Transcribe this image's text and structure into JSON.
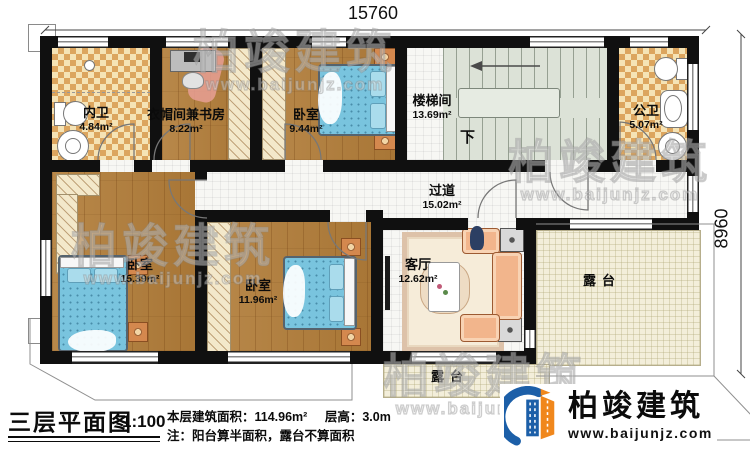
{
  "plan": {
    "dim_width": "15760",
    "dim_height": "8960",
    "rooms": {
      "inner_bath": {
        "name": "内卫",
        "area": "4.84m²"
      },
      "cloak_study": {
        "name": "衣帽间兼书房",
        "area": "8.22m²"
      },
      "bedroom_north": {
        "name": "卧室",
        "area": "9.44m²"
      },
      "stairwell": {
        "name": "楼梯间",
        "area": "13.69m²"
      },
      "public_bath": {
        "name": "公卫",
        "area": "5.07m²"
      },
      "hallway": {
        "name": "过道",
        "area": "15.02m²"
      },
      "bedroom_west": {
        "name": "卧室",
        "area": "15.39m²"
      },
      "bedroom_south": {
        "name": "卧室",
        "area": "11.96m²"
      },
      "living_room": {
        "name": "客厅",
        "area": "12.62m²"
      },
      "terrace_east": {
        "name": "露台"
      },
      "terrace_south": {
        "name": "露台"
      }
    },
    "stairs_down_label": "下"
  },
  "title_block": {
    "title": "三层平面图",
    "scale": "1:100",
    "area_line": "本层建筑面积：114.96m²",
    "height_line": "层高：3.0m",
    "note": "注：阳台算半面积，露台不算面积"
  },
  "logo": {
    "company": "柏竣建筑",
    "website": "www.baijunjz.com"
  },
  "watermark": {
    "line1": "柏竣建筑",
    "line2": "www.baijunjz.com"
  },
  "colors": {
    "wall": "#101010",
    "accent_blue": "#1c5fa8",
    "accent_orange": "#f0871c",
    "bed_blue": "#79c4de",
    "wood_floor": "#b08040",
    "bath_tile": "#dca55e",
    "terrace": "#f3eeda",
    "stairs": "#dce2d7"
  }
}
